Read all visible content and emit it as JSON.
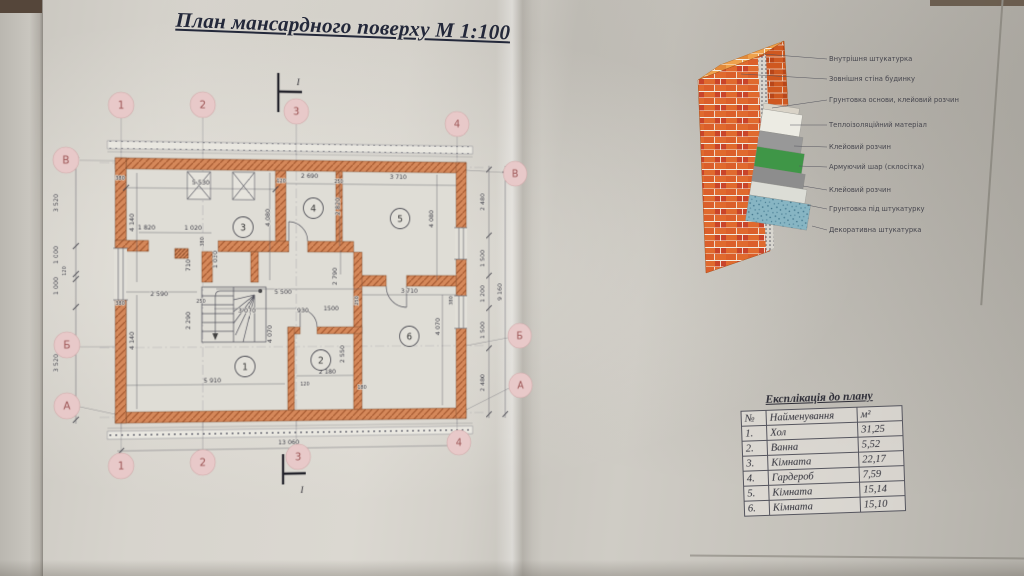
{
  "sheet": {
    "title": "План мансардного поверху М 1:100"
  },
  "plan": {
    "axes": {
      "top": [
        "1",
        "2",
        "3",
        "4"
      ],
      "bottom": [
        "1",
        "2",
        "3",
        "4"
      ],
      "left": [
        "В",
        "Б",
        "А"
      ],
      "right": [
        "В",
        "Б",
        "А"
      ]
    },
    "section_label": "I",
    "rooms": [
      "1",
      "2",
      "3",
      "4",
      "5",
      "6"
    ],
    "dims": [
      "5 530",
      "2 690",
      "3 710",
      "120",
      "250",
      "4 140",
      "4 080",
      "2 820",
      "4 080",
      "1 820",
      "1 020",
      "380",
      "1 030",
      "710",
      "2 590",
      "250",
      "2 290",
      "4 140",
      "5 500",
      "3 070",
      "930",
      "1500",
      "2 790",
      "4 070",
      "250",
      "3 710",
      "380",
      "2 550",
      "2 180",
      "5 910",
      "4 070",
      "13 060",
      "9 160",
      "2 480",
      "1 500",
      "1 200",
      "1 500",
      "2 480",
      "3 520",
      "1 000",
      "120",
      "1 000",
      "3 520",
      "380",
      "380",
      "120",
      "180"
    ]
  },
  "wall_detail": {
    "layers": [
      "Внутрішня штукатурка",
      "Зовнішня стіна будинку",
      "Грунтовка основи, клейовий розчин",
      "Теплоізоляційний матеріал",
      "Клейовий розчин",
      "Армуючий шар (склосітка)",
      "Клейовий розчин",
      "Грунтовка під штукатурку",
      "Декоративна штукатурка"
    ]
  },
  "legend_table": {
    "title": "Експлікація до плану",
    "headers": [
      "№",
      "Найменування",
      "м²"
    ],
    "rows": [
      {
        "n": "1.",
        "name": "Хол",
        "area": "31,25"
      },
      {
        "n": "2.",
        "name": "Ванна",
        "area": "5,52"
      },
      {
        "n": "3.",
        "name": "Кімната",
        "area": "22,17"
      },
      {
        "n": "4.",
        "name": "Гардероб",
        "area": "7,59"
      },
      {
        "n": "5.",
        "name": "Кімната",
        "area": "15,14"
      },
      {
        "n": "6.",
        "name": "Кімната",
        "area": "15,10"
      }
    ]
  },
  "colors": {
    "wall_fill": "#d5885a",
    "wall_hatch": "#a65a31",
    "bubble_fill": "#e8c9c9",
    "bubble_text": "#9c5454",
    "ink": "#3c3c46",
    "brick_orange": "#e06a2e",
    "brick_red": "#c9442a",
    "brick_top": "#efa24d",
    "layer_white": "#ecebe3",
    "layer_gray": "#989898",
    "layer_green": "#3f9647",
    "layer_gray2": "#8d8d8d",
    "layer_light": "#dcddd6",
    "layer_blue": "#87b5c3"
  }
}
